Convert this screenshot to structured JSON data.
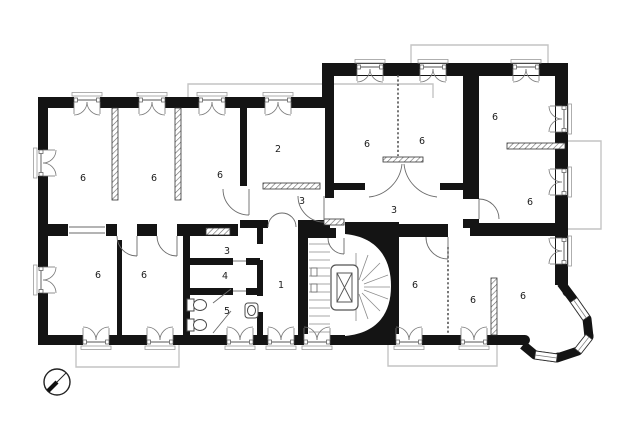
{
  "plan": {
    "title": "apartment-floor-plan",
    "rooms": [
      {
        "number": "6"
      },
      {
        "number": "6"
      },
      {
        "number": "6"
      },
      {
        "number": "2"
      },
      {
        "number": "6"
      },
      {
        "number": "6"
      },
      {
        "number": "6"
      },
      {
        "number": "6"
      },
      {
        "number": "3"
      },
      {
        "number": "3"
      },
      {
        "number": "3"
      },
      {
        "number": "4"
      },
      {
        "number": "5"
      },
      {
        "number": "1"
      },
      {
        "number": "6"
      },
      {
        "number": "6"
      },
      {
        "number": "6"
      },
      {
        "number": "6"
      },
      {
        "number": "6"
      }
    ],
    "colors": {
      "wall": "#141414",
      "partition_hatch": "#666666",
      "door_swing": "#6a6a6a",
      "window_sill": "#9a9a9a",
      "balcony_outline": "#c4c4c4",
      "stair_tread": "#8a8a8a",
      "label": "#1c1c1c",
      "background": "#ffffff"
    }
  }
}
